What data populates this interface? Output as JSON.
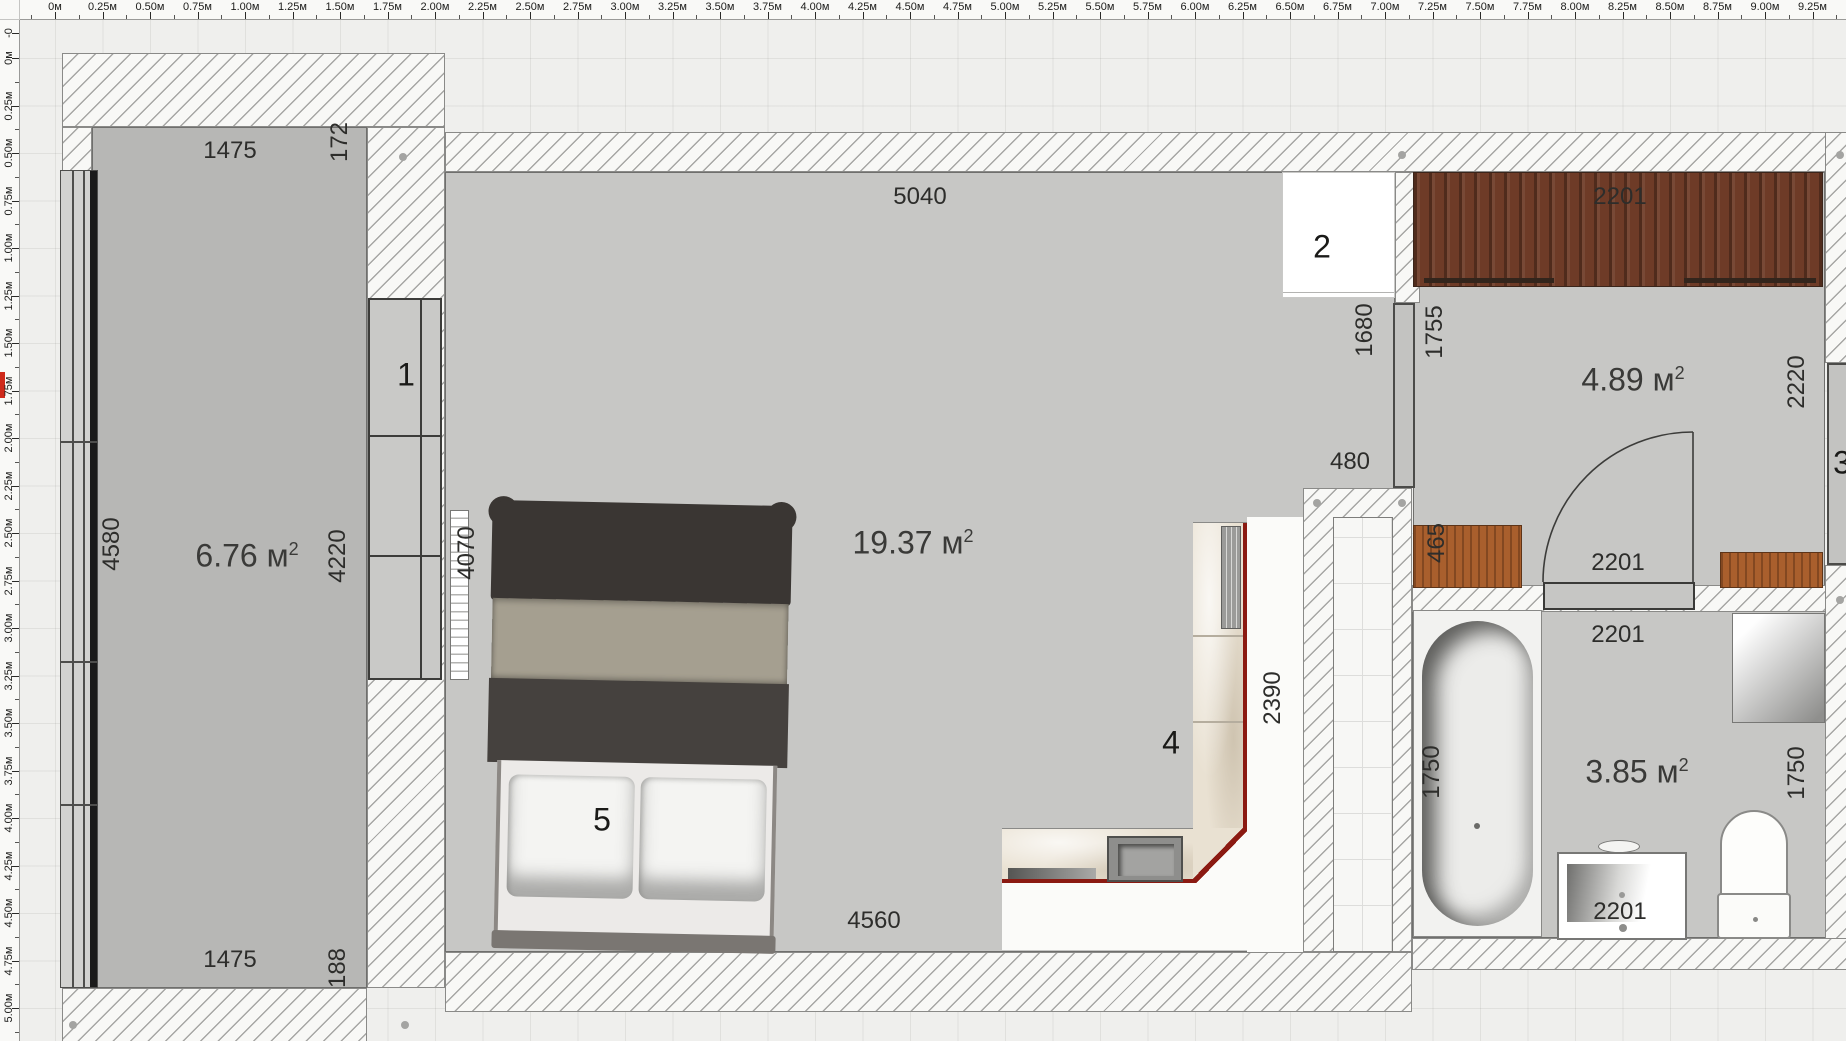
{
  "app": {
    "canvas_bg": "#efefed",
    "wall_fill": "#f8f8f6",
    "wall_line": "#a6a6a4",
    "floor_gray": "#c7c7c5",
    "accent_red": "#8b1a12",
    "ruler_marker_color": "#cf2a1b"
  },
  "rulers": {
    "horizontal": {
      "labels": [
        "0м",
        "0.25м",
        "0.50м",
        "0.75м",
        "1.00м",
        "1.25м",
        "1.50м",
        "1.75м",
        "2.00м",
        "2.25м",
        "2.50м",
        "2.75м",
        "3.00м",
        "3.25м",
        "3.50м",
        "3.75м",
        "4.00м",
        "4.25м",
        "4.50м",
        "4.75м",
        "5.00м",
        "5.25м",
        "5.50м",
        "5.75м",
        "6.00м",
        "6.25м",
        "6.50м",
        "6.75м",
        "7.00м",
        "7.25м",
        "7.50м",
        "7.75м",
        "8.00м",
        "8.25м",
        "8.50м",
        "8.75м",
        "9.00м",
        "9.25м"
      ]
    },
    "vertical": {
      "labels": [
        "-0",
        "0м",
        "0.25м",
        "0.50м",
        "0.75м",
        "1.00м",
        "1.25м",
        "1.50м",
        "1.75м",
        "2.00м",
        "2.25м",
        "2.50м",
        "2.75м",
        "3.00м",
        "3.25м",
        "3.50м",
        "3.75м",
        "4.00м",
        "4.25м",
        "4.50м",
        "4.75м",
        "5.00м"
      ]
    }
  },
  "rooms": [
    {
      "id": "balcony",
      "area": "6.76",
      "unit": "м",
      "sup": "2",
      "x": 227,
      "y": 536
    },
    {
      "id": "living",
      "area": "19.37",
      "unit": "м",
      "sup": "2",
      "x": 893,
      "y": 523
    },
    {
      "id": "hallway",
      "area": "4.89",
      "unit": "м",
      "sup": "2",
      "x": 1613,
      "y": 360
    },
    {
      "id": "bathroom",
      "area": "3.85",
      "unit": "м",
      "sup": "2",
      "x": 1617,
      "y": 752
    }
  ],
  "labels": [
    {
      "text": "1475",
      "x": 210,
      "y": 131,
      "o": "h",
      "k": "dim"
    },
    {
      "text": "172",
      "x": 320,
      "y": 122,
      "o": "v",
      "k": "dim"
    },
    {
      "text": "4580",
      "x": 92,
      "y": 524,
      "o": "v",
      "k": "dim"
    },
    {
      "text": "4220",
      "x": 318,
      "y": 536,
      "o": "v",
      "k": "dim"
    },
    {
      "text": "1475",
      "x": 210,
      "y": 940,
      "o": "h",
      "k": "dim"
    },
    {
      "text": "188",
      "x": 318,
      "y": 948,
      "o": "v",
      "k": "dim"
    },
    {
      "text": "5040",
      "x": 900,
      "y": 177,
      "o": "h",
      "k": "dim"
    },
    {
      "text": "4070",
      "x": 447,
      "y": 533,
      "o": "v",
      "k": "dim"
    },
    {
      "text": "4560",
      "x": 854,
      "y": 901,
      "o": "h",
      "k": "dim"
    },
    {
      "text": "1680",
      "x": 1345,
      "y": 310,
      "o": "v",
      "k": "dim"
    },
    {
      "text": "480",
      "x": 1330,
      "y": 442,
      "o": "h",
      "k": "dim"
    },
    {
      "text": "2390",
      "x": 1253,
      "y": 678,
      "o": "v",
      "k": "dim"
    },
    {
      "text": "2201",
      "x": 1600,
      "y": 177,
      "o": "h",
      "k": "dim"
    },
    {
      "text": "1755",
      "x": 1415,
      "y": 312,
      "o": "v",
      "k": "dim"
    },
    {
      "text": "2220",
      "x": 1777,
      "y": 362,
      "o": "v",
      "k": "dim"
    },
    {
      "text": "465",
      "x": 1417,
      "y": 523,
      "o": "v",
      "k": "dim"
    },
    {
      "text": "2201",
      "x": 1598,
      "y": 543,
      "o": "h",
      "k": "dim"
    },
    {
      "text": "2201",
      "x": 1598,
      "y": 615,
      "o": "h",
      "k": "dim"
    },
    {
      "text": "1750",
      "x": 1412,
      "y": 752,
      "o": "v",
      "k": "dim"
    },
    {
      "text": "1750",
      "x": 1777,
      "y": 753,
      "o": "v",
      "k": "dim"
    },
    {
      "text": "2201",
      "x": 1600,
      "y": 892,
      "o": "h",
      "k": "dim"
    },
    {
      "text": "1",
      "x": 386,
      "y": 355,
      "o": "h",
      "k": "marker"
    },
    {
      "text": "2",
      "x": 1302,
      "y": 227,
      "o": "h",
      "k": "marker"
    },
    {
      "text": "3",
      "x": 1822,
      "y": 443,
      "o": "h",
      "k": "marker"
    },
    {
      "text": "4",
      "x": 1151,
      "y": 723,
      "o": "h",
      "k": "marker"
    },
    {
      "text": "5",
      "x": 582,
      "y": 800,
      "o": "h",
      "k": "marker"
    }
  ],
  "dots": [
    [
      383,
      137
    ],
    [
      1382,
      135
    ],
    [
      1820,
      135
    ],
    [
      1297,
      483
    ],
    [
      1382,
      483
    ],
    [
      1820,
      580
    ],
    [
      385,
      1005
    ],
    [
      53,
      1005
    ]
  ]
}
